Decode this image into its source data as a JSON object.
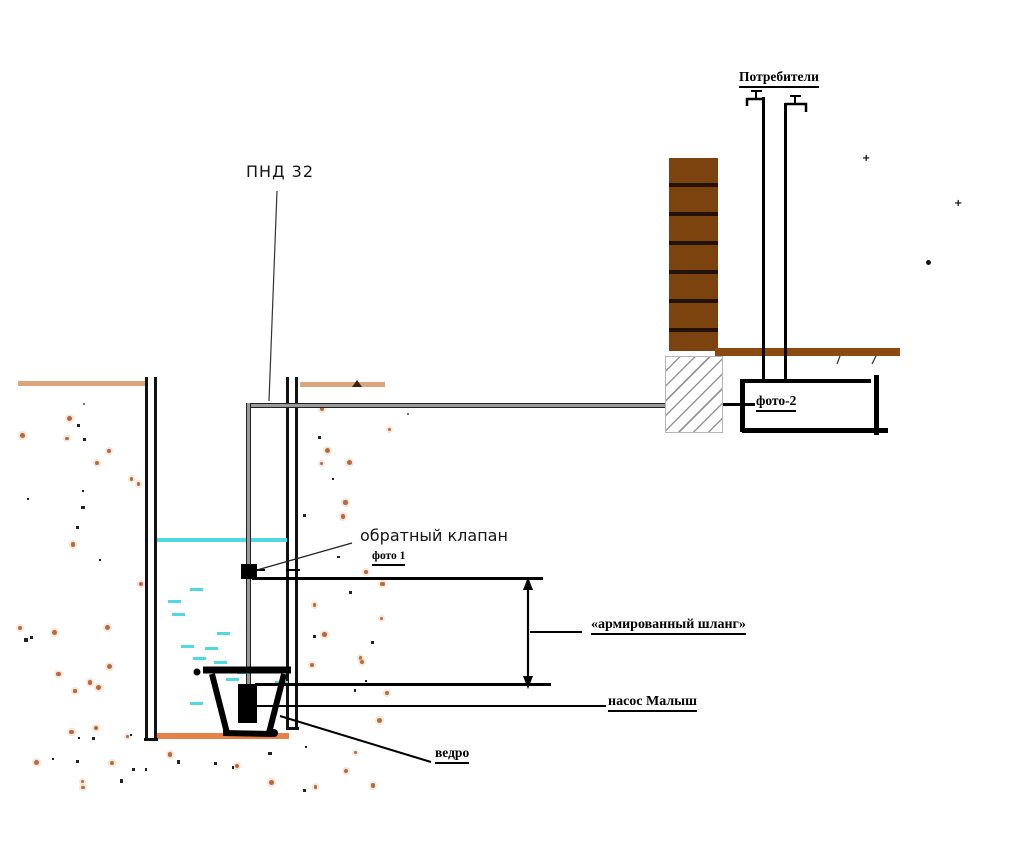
{
  "diagram": {
    "labels": {
      "pnd32": "ПНД 32",
      "consumers": "Потребители",
      "check_valve": "обратный клапан",
      "photo1": "фото 1",
      "photo2": "фото-2",
      "hose": "«армированный шланг»",
      "pump": "насос Малыш",
      "bucket": "ведро"
    },
    "colors": {
      "water": "#4fd9e3",
      "ground": "#dba479",
      "well_bottom": "#e87f47",
      "brick": "#7c430f",
      "brick_joint": "#241204",
      "floor": "#8a4a12",
      "pipe_fill": "#9a9a9a",
      "soil_dot": "#b96a3c"
    },
    "water_dashes": [
      [
        168,
        600
      ],
      [
        190,
        588
      ],
      [
        172,
        613
      ],
      [
        217,
        632
      ],
      [
        181,
        645
      ],
      [
        205,
        647
      ],
      [
        193,
        657
      ],
      [
        214,
        661
      ],
      [
        226,
        678
      ],
      [
        275,
        681
      ],
      [
        237,
        671
      ],
      [
        190,
        702
      ]
    ],
    "soil_regions": [
      {
        "x": 15,
        "y": 392,
        "w": 125,
        "h": 350,
        "count": 32
      },
      {
        "x": 303,
        "y": 390,
        "w": 88,
        "h": 335,
        "count": 26
      },
      {
        "x": 15,
        "y": 744,
        "w": 368,
        "h": 46,
        "count": 22
      }
    ],
    "noise_marks": [
      {
        "x": 862,
        "y": 159,
        "type": "plus"
      },
      {
        "x": 954,
        "y": 204,
        "type": "plus"
      },
      {
        "x": 926,
        "y": 260,
        "type": "dot"
      },
      {
        "x": 407,
        "y": 413,
        "type": "small"
      },
      {
        "x": 83,
        "y": 403,
        "type": "small"
      }
    ]
  }
}
